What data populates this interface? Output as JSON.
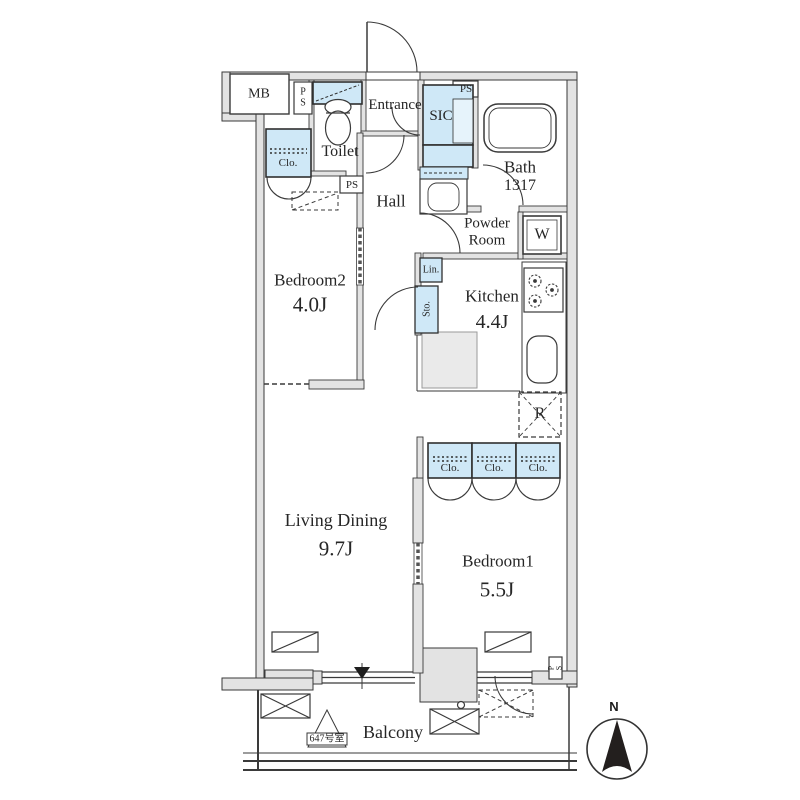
{
  "plan": {
    "unit_label": "647号室",
    "compass_north": "N",
    "rooms": {
      "bedroom2": {
        "name": "Bedroom2",
        "size": "4.0J"
      },
      "bedroom1": {
        "name": "Bedroom1",
        "size": "5.5J"
      },
      "living_dining": {
        "name": "Living Dining",
        "size": "9.7J"
      },
      "kitchen": {
        "name": "Kitchen",
        "size": "4.4J"
      },
      "bath": {
        "name": "Bath",
        "size": "1317"
      },
      "toilet": {
        "name": "Toilet"
      },
      "hall": {
        "name": "Hall"
      },
      "entrance": {
        "name": "Entrance"
      },
      "powder_room": {
        "name": "Powder Room"
      },
      "balcony": {
        "name": "Balcony"
      },
      "sic": {
        "name": "SIC"
      }
    },
    "small_labels": {
      "mb": "MB",
      "ps": "PS",
      "closet": "Clo.",
      "linen": "Lin.",
      "storage": "Sto.",
      "washer": "W",
      "refrigerator": "R"
    },
    "colors": {
      "closet_fill": "#cfe8f7",
      "closet_fill_light": "#e6f3fb",
      "wall_fill": "#e3e3e3",
      "line": "#3a3a3a"
    }
  }
}
